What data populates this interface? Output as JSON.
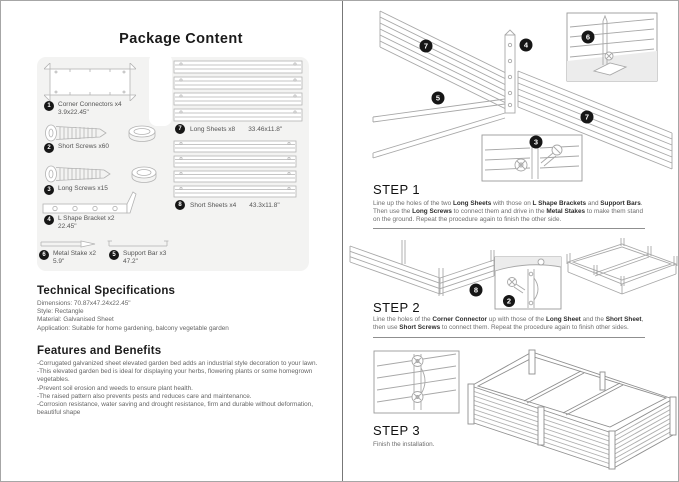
{
  "page_title": "Package Content",
  "package": {
    "items": [
      {
        "num": "1",
        "name": "Corner Connectors x4",
        "size": "3.9x22.45\""
      },
      {
        "num": "2",
        "name": "Short Screws x60",
        "size": ""
      },
      {
        "num": "3",
        "name": "Long Screws x15",
        "size": ""
      },
      {
        "num": "4",
        "name": "L Shape Bracket x2",
        "size": "22.45\""
      },
      {
        "num": "5",
        "name": "Support Bar x3",
        "size": "47.2\""
      },
      {
        "num": "6",
        "name": "Metal Stake x2",
        "size": "5.9\""
      },
      {
        "num": "7",
        "name": "Long Sheets x8",
        "size": "33.46x11.8\""
      },
      {
        "num": "8",
        "name": "Short Sheets x4",
        "size": "43.3x11.8\""
      }
    ]
  },
  "tech_specs": {
    "heading": "Technical Specifications",
    "lines": [
      "Dimensions:  70.87x47.24x22.45\"",
      "Style: Rectangle",
      "Material: Galvanised Sheet",
      "Application: Suitable for home gardening, balcony vegetable garden"
    ]
  },
  "features": {
    "heading": "Features and Benefits",
    "bullets": [
      "-Corrugated galvanized sheet elevated garden bed adds an industrial style decoration to your lawn.",
      "-This elevated garden bed is ideal for displaying your herbs, flowering plants or some homegrown vegetables.",
      "-Prevent soil erosion and weeds to ensure plant health.",
      "-The raised pattern also prevents pests and reduces care and maintenance.",
      "-Corrosion resistance, water saving and drought resistance, firm and durable without deformation, beautiful shape"
    ]
  },
  "steps": {
    "step1": {
      "heading": "STEP 1",
      "text": [
        {
          "t": "Line up the holes of the two ",
          "b": false
        },
        {
          "t": "Long Sheets",
          "b": true
        },
        {
          "t": " with those on ",
          "b": false
        },
        {
          "t": "L Shape Brackets",
          "b": true
        },
        {
          "t": " and ",
          "b": false
        },
        {
          "t": "Support Bars",
          "b": true
        },
        {
          "t": ". Then use the ",
          "b": false
        },
        {
          "t": "Long Screws",
          "b": true
        },
        {
          "t": " to connect them and drive in the ",
          "b": false
        },
        {
          "t": "Metal Stakes",
          "b": true
        },
        {
          "t": " to make them stand on the ground. Repeat the procedure again to finish the other side.",
          "b": false
        }
      ]
    },
    "step2": {
      "heading": "STEP 2",
      "text": [
        {
          "t": "Line the holes of the ",
          "b": false
        },
        {
          "t": "Corner Connector",
          "b": true
        },
        {
          "t": " up with those of the ",
          "b": false
        },
        {
          "t": "Long Sheet",
          "b": true
        },
        {
          "t": " and the ",
          "b": false
        },
        {
          "t": "Short Sheet",
          "b": true
        },
        {
          "t": ", then use ",
          "b": false
        },
        {
          "t": "Short Screws",
          "b": true
        },
        {
          "t": " to connect them. Repeat the procedure again to finish other sides.",
          "b": false
        }
      ]
    },
    "step3": {
      "heading": "STEP 3",
      "text": [
        {
          "t": "Finish the installation.",
          "b": false
        }
      ]
    }
  },
  "diagram_badges": {
    "step1": [
      "7",
      "4",
      "6",
      "5",
      "7",
      "3"
    ],
    "step2": [
      "8",
      "2"
    ]
  },
  "colors": {
    "panel_bg": "#f3f3f2",
    "line_art": "#a8a8a8",
    "badge": "#161616"
  }
}
